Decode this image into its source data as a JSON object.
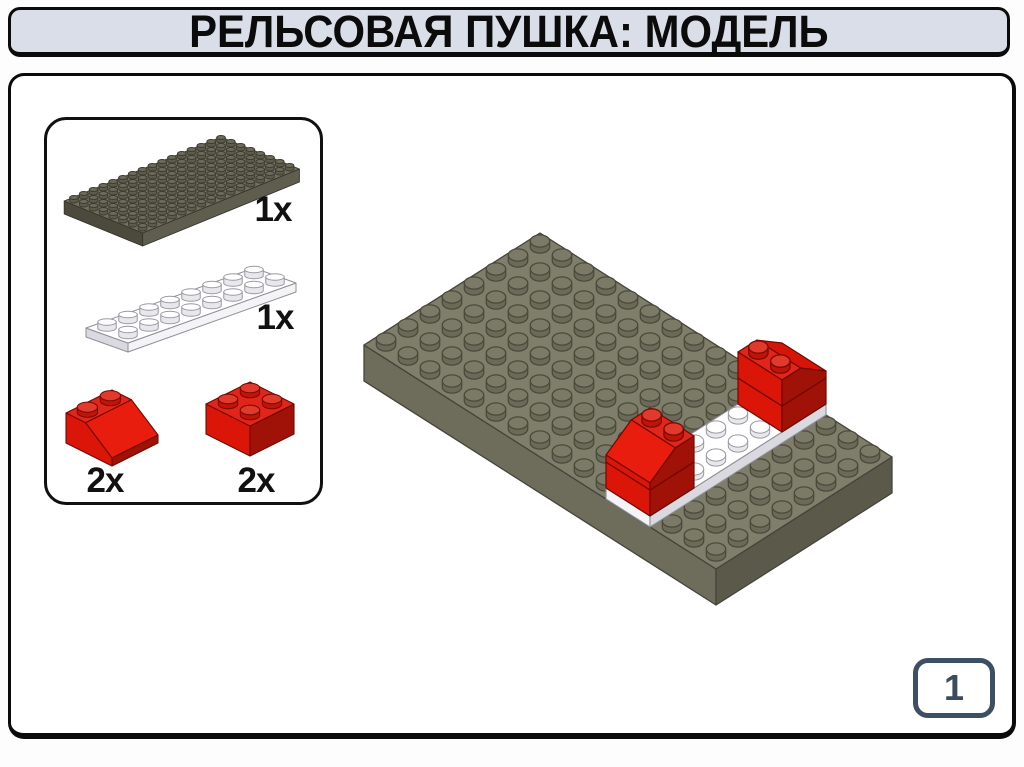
{
  "title": {
    "text": "РЕЛЬСОВАЯ ПУШКА: МОДЕЛЬ"
  },
  "parts_panel": {
    "items": [
      {
        "part": "plate-8x16-dark-gray",
        "count": "1x"
      },
      {
        "part": "plate-2x8-white",
        "count": "1x"
      },
      {
        "part": "slope-2x2-red",
        "count": "2x"
      },
      {
        "part": "brick-2x2-red",
        "count": "2x"
      }
    ]
  },
  "page_indicator": {
    "number": "1"
  },
  "colors": {
    "title_bar_bg": "#d9dee9",
    "outline": "#0b0b0b",
    "page_badge_border": "#3d4f63",
    "page_badge_text": "#3a4c60",
    "lego": {
      "gray": {
        "top": "#7f7e6a",
        "face": "#6e6d5c",
        "side": "#5b594a",
        "line": "#45443a",
        "stud": "#7b7a66",
        "studSide": "#6b6a58",
        "studLine": "#4b4a3c"
      },
      "grayDark": {
        "top": "#716f5e",
        "face": "#5f5d4e",
        "side": "#4b4a3d",
        "line": "#35342b",
        "stud": "#6d6b5a",
        "studSide": "#5d5b4c",
        "studLine": "#3d3c31"
      },
      "red": {
        "top": "#e2251a",
        "face": "#dc1509",
        "slope": "#e81d0d",
        "slopeBack": "#d61408",
        "side": "#a01107",
        "line": "#6f0a03",
        "stud": "#e03a2c",
        "studSide": "#c01408",
        "studLine": "#7a0b04"
      },
      "white": {
        "top": "#ffffff",
        "face": "#f4f4f7",
        "side": "#d9d9df",
        "line": "#8f8f97",
        "stud": "#ffffff",
        "studSide": "#e7e7ec",
        "studLine": "#9a9aa1"
      }
    }
  }
}
